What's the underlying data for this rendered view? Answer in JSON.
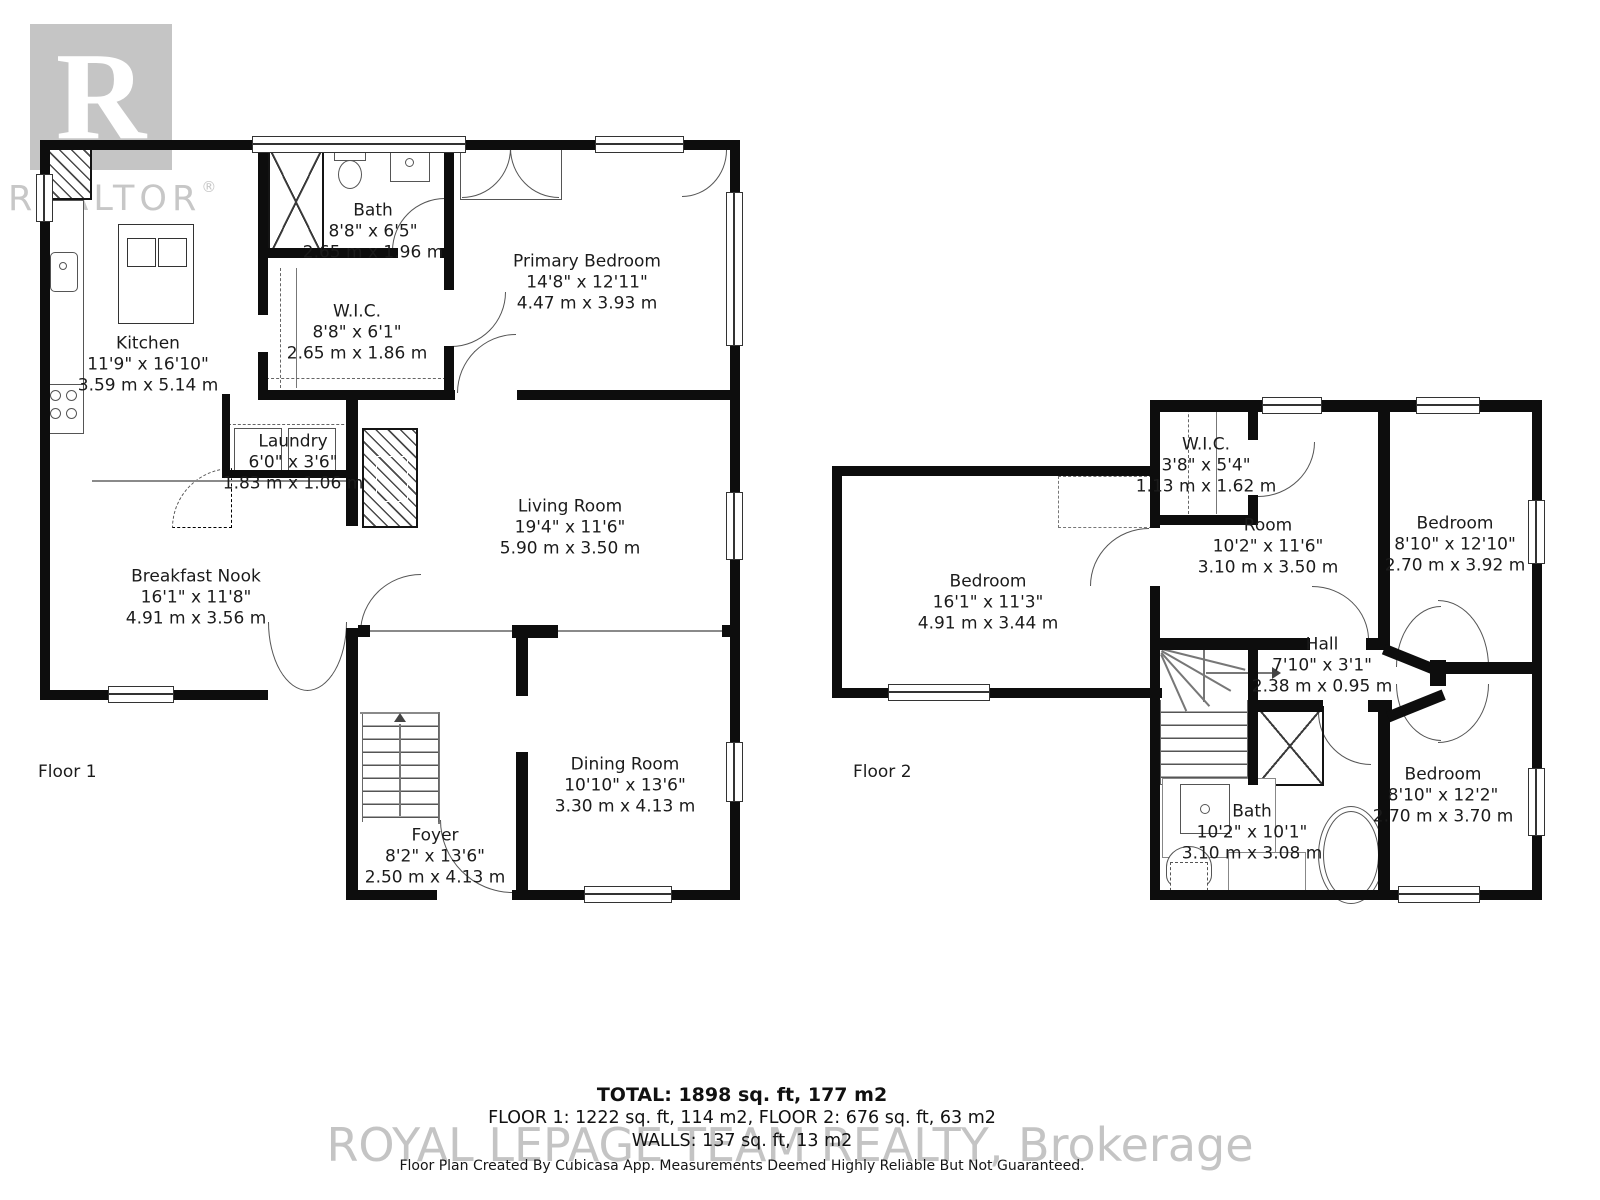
{
  "logo": {
    "letter": "R",
    "brand": "REALTOR",
    "registered": "®"
  },
  "floor1": {
    "label": "Floor 1",
    "rooms": [
      {
        "name": "Bath",
        "imperial": "8'8\" x 6'5\"",
        "metric": "2.65 m x 1.96 m"
      },
      {
        "name": "Primary Bedroom",
        "imperial": "14'8\" x 12'11\"",
        "metric": "4.47 m x 3.93 m"
      },
      {
        "name": "Kitchen",
        "imperial": "11'9\" x 16'10\"",
        "metric": "3.59 m x 5.14 m"
      },
      {
        "name": "W.I.C.",
        "imperial": "8'8\" x 6'1\"",
        "metric": "2.65 m x 1.86 m"
      },
      {
        "name": "Laundry",
        "imperial": "6'0\" x 3'6\"",
        "metric": "1.83 m x 1.06 m"
      },
      {
        "name": "Living Room",
        "imperial": "19'4\" x 11'6\"",
        "metric": "5.90 m x 3.50 m"
      },
      {
        "name": "Breakfast Nook",
        "imperial": "16'1\" x 11'8\"",
        "metric": "4.91 m x 3.56 m"
      },
      {
        "name": "Dining Room",
        "imperial": "10'10\" x 13'6\"",
        "metric": "3.30 m x 4.13 m"
      },
      {
        "name": "Foyer",
        "imperial": "8'2\" x 13'6\"",
        "metric": "2.50 m x 4.13 m"
      }
    ]
  },
  "floor2": {
    "label": "Floor 2",
    "rooms": [
      {
        "name": "W.I.C.",
        "imperial": "3'8\" x 5'4\"",
        "metric": "1.13 m x 1.62 m"
      },
      {
        "name": "Room",
        "imperial": "10'2\" x 11'6\"",
        "metric": "3.10 m x 3.50 m"
      },
      {
        "name": "Bedroom",
        "imperial": "8'10\" x 12'10\"",
        "metric": "2.70 m x 3.92 m"
      },
      {
        "name": "Bedroom",
        "imperial": "16'1\" x 11'3\"",
        "metric": "4.91 m x 3.44 m"
      },
      {
        "name": "Hall",
        "imperial": "7'10\" x 3'1\"",
        "metric": "2.38 m x 0.95 m"
      },
      {
        "name": "Bedroom",
        "imperial": "8'10\" x 12'2\"",
        "metric": "2.70 m x 3.70 m"
      },
      {
        "name": "Bath",
        "imperial": "10'2\" x 10'1\"",
        "metric": "3.10 m x 3.08 m"
      }
    ]
  },
  "summary": {
    "total": "TOTAL: 1898 sq. ft, 177 m2",
    "floors": "FLOOR 1: 1222 sq. ft, 114 m2, FLOOR 2: 676 sq. ft, 63 m2",
    "walls": "WALLS: 137 sq. ft, 13 m2"
  },
  "watermark": "ROYAL LEPAGE TEAM REALTY, Brokerage",
  "disclaimer": "Floor Plan Created By Cubicasa App. Measurements Deemed Highly Reliable But Not Guaranteed."
}
